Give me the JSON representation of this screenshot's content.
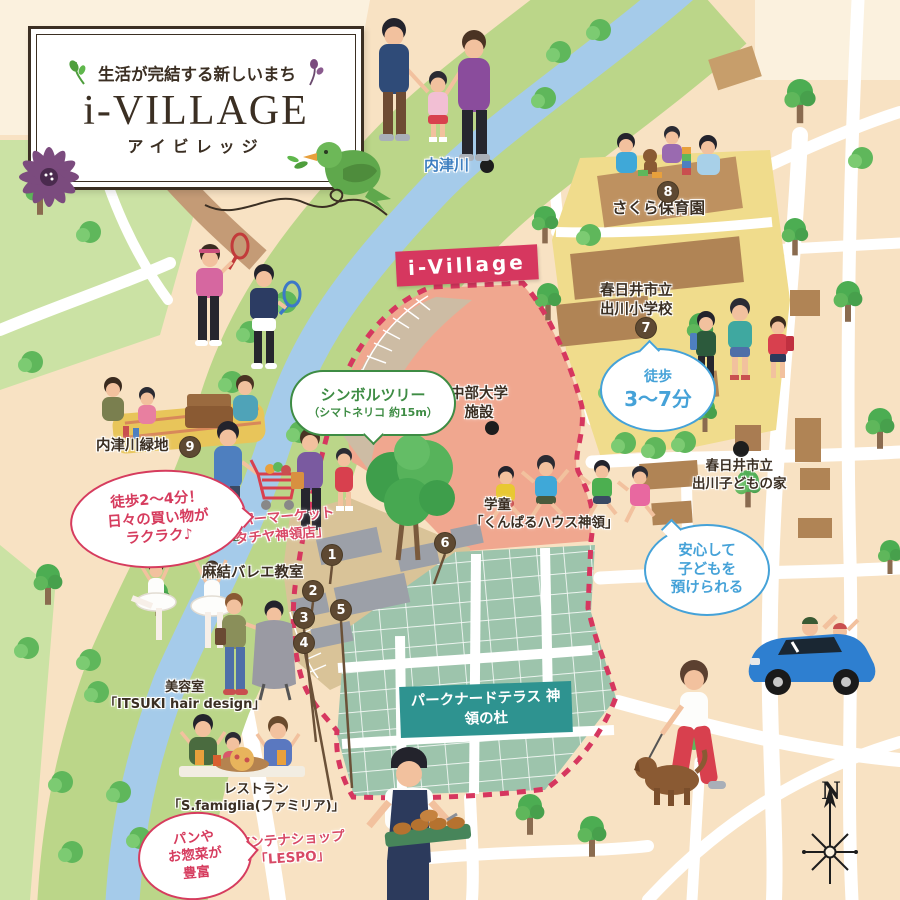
{
  "title_card": {
    "tagline": "生活が完結する新しいまち",
    "title": "i-VILLAGE",
    "subtitle": "アイビレッジ"
  },
  "site_banner": "i-Village",
  "compass": "N",
  "labels": {
    "river": "内津川",
    "nursery": "さくら保育園",
    "elementary1": "春日井市立",
    "elementary2": "出川小学校",
    "kodomo1": "春日井市立",
    "kodomo2": "出川子どもの家",
    "univ1": "中部大学",
    "univ2": "施設",
    "gakudo1": "学童",
    "gakudo2": "「くんぱるハウス神領」",
    "greenspace": "内津川緑地",
    "super1": "スーパーマーケット",
    "super2": "「タチヤ神領店」",
    "ballet": "麻結バレエ教室",
    "salon1": "美容室",
    "salon2": "「ITSUKI hair design」",
    "resto1": "レストラン",
    "resto2": "「S.famiglia(ファミリア)」",
    "antenna1": "アンテナショップ",
    "antenna2": "「LESPO」",
    "terrace1": "パークナードテラス",
    "terrace2": "神領の杜"
  },
  "bubbles": {
    "tree1": "シンボルツリー",
    "tree2": "（シマトネリコ 約15m）",
    "walk1": "徒歩",
    "walk2": "3〜7分",
    "safe1": "安心して",
    "safe2": "子どもを",
    "safe3": "預けられる",
    "shop1": "徒歩2〜4分！",
    "shop2": "日々の買い物が",
    "shop3": "ラクラク♪",
    "bake1": "パンや",
    "bake2": "お惣菜が",
    "bake3": "豊富"
  },
  "markers": [
    {
      "number": "1"
    },
    {
      "number": "2"
    },
    {
      "number": "3"
    },
    {
      "number": "4"
    },
    {
      "number": "5"
    },
    {
      "number": "6"
    },
    {
      "number": "7"
    },
    {
      "number": "8"
    },
    {
      "number": "9"
    }
  ],
  "colors": {
    "accent_red": "#D63C5E",
    "accent_blue": "#45A2D8",
    "accent_green": "#3E8C44",
    "banner_red": "#D6375F",
    "banner_teal": "#2E9390",
    "river_blue": "#A5CBEA",
    "bank_green": "#BBD689",
    "site_salmon": "#F0A78F",
    "housing_teal": "#9DC4AC",
    "school_yellow": "#F0DC8C",
    "marker_brown": "#5E4932"
  }
}
